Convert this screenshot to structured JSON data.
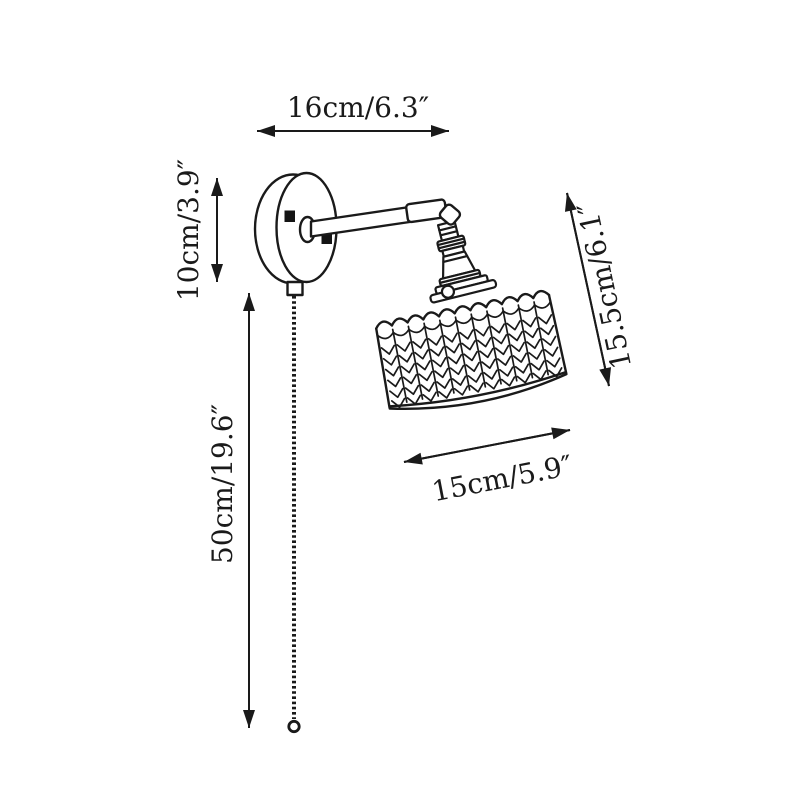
{
  "diagram": {
    "title": "wall lamp dimension diagram",
    "background_color": "#ffffff",
    "line_color": "#1a1a1a",
    "dimensions": {
      "depth": {
        "label": "16cm/6.3″"
      },
      "plate": {
        "label": "10cm/3.9″"
      },
      "chain": {
        "label": "50cm/19.6″"
      },
      "height": {
        "label": "15.5cm/6.1″"
      },
      "shade": {
        "label": "15cm/5.9″"
      }
    },
    "components": [
      "wall-plate",
      "swing-arm",
      "elbow-joint",
      "lamp-socket",
      "drum-shade",
      "pull-chain-with-ring"
    ]
  }
}
